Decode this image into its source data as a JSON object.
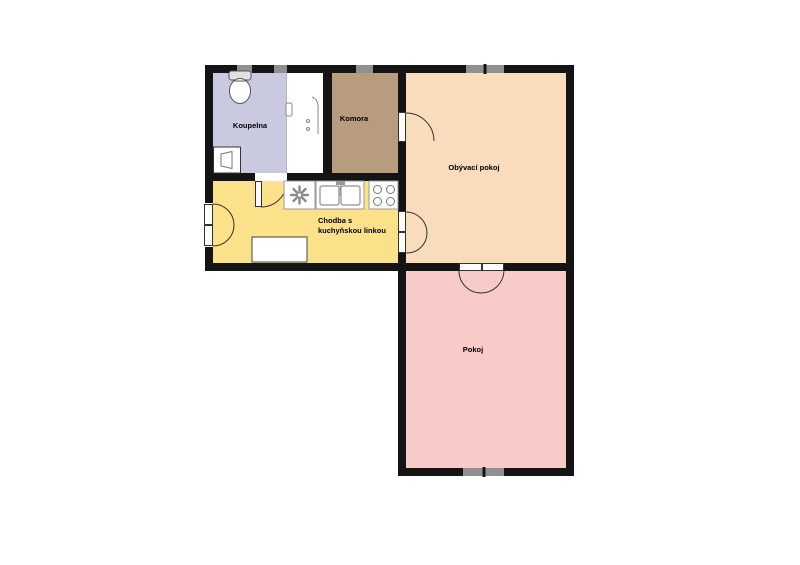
{
  "title": "Byt - půdorys",
  "rooms": {
    "koupelna": {
      "label": "Koupelna",
      "color": "#c9c9e0"
    },
    "komora": {
      "label": "Komora",
      "color": "#b79d7d"
    },
    "obyvaci_pokoj": {
      "label": "Obývací pokoj",
      "color": "#f8dcbc"
    },
    "chodba": {
      "label_line1": "Chodba s",
      "label_line2": "kuchyňskou linkou",
      "color": "#fbe28a"
    },
    "pokoj": {
      "label": "Pokoj",
      "color": "#f9cbc8"
    }
  },
  "colors": {
    "wall": "#141414",
    "window": "#909090",
    "background": "#ffffff",
    "door_arc": "#333333",
    "fixture_outline": "#888888"
  },
  "fixtures": {
    "bathroom": [
      "toilet",
      "washbasin",
      "bathtub"
    ],
    "kitchen": [
      "vent-fan",
      "double-sink",
      "stove",
      "table"
    ]
  },
  "openings": {
    "windows": [
      "bathroom-window-1",
      "bathroom-window-2",
      "komora-window",
      "living-room-window",
      "pokoj-window"
    ],
    "doors": [
      "entrance-double-door",
      "bathroom-door",
      "komora-door",
      "living-room-double-door",
      "pokoj-double-door"
    ]
  }
}
